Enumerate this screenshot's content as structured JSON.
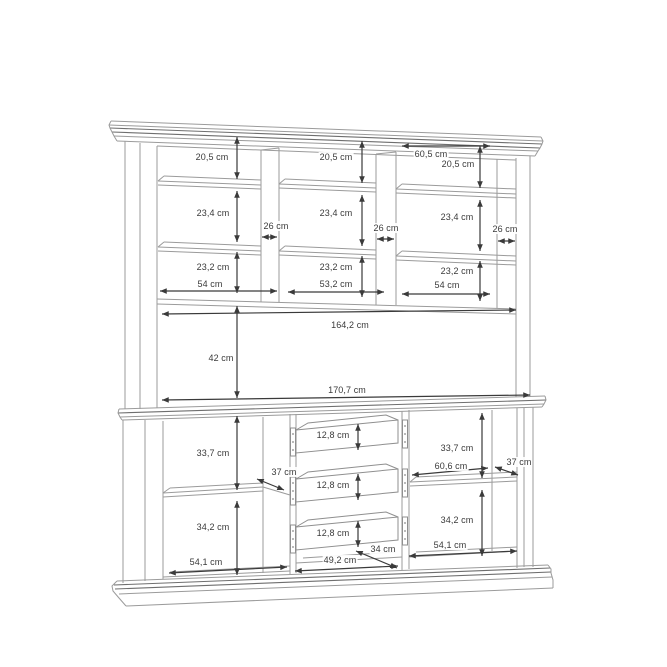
{
  "dims": {
    "upper": {
      "left": {
        "top": "20,5 cm",
        "middle": "23,4 cm",
        "bottom": "23,2 cm",
        "width": "54 cm",
        "depth": "26 cm"
      },
      "center": {
        "top": "20,5 cm",
        "middle": "23,4 cm",
        "bottom": "23,2 cm",
        "width": "53,2 cm",
        "depth": "26 cm"
      },
      "right": {
        "opening": "60,5 cm",
        "top": "20,5 cm",
        "middle": "23,4 cm",
        "bottom": "23,2 cm",
        "width": "54 cm",
        "depth": "26 cm"
      },
      "open": {
        "inner_width": "164,2 cm",
        "height": "42 cm",
        "outer_width": "170,7 cm"
      }
    },
    "lower": {
      "left": {
        "upper": "33,7 cm",
        "depth": "37 cm",
        "lower": "34,2 cm",
        "width": "54,1 cm"
      },
      "drawers": {
        "d1": "12,8 cm",
        "d2": "12,8 cm",
        "d3": "12,8 cm",
        "depth": "34 cm",
        "width": "49,2 cm"
      },
      "right": {
        "upper": "33,7 cm",
        "shelf_width": "60,6 cm",
        "depth": "37 cm",
        "lower": "34,2 cm",
        "width": "54,1 cm"
      }
    }
  },
  "colors": {
    "background": "#ffffff",
    "structure_line": "#9b9b9b",
    "dimension_line": "#3a3a3a",
    "label_text": "#3a3a3a"
  },
  "unit": "cm"
}
